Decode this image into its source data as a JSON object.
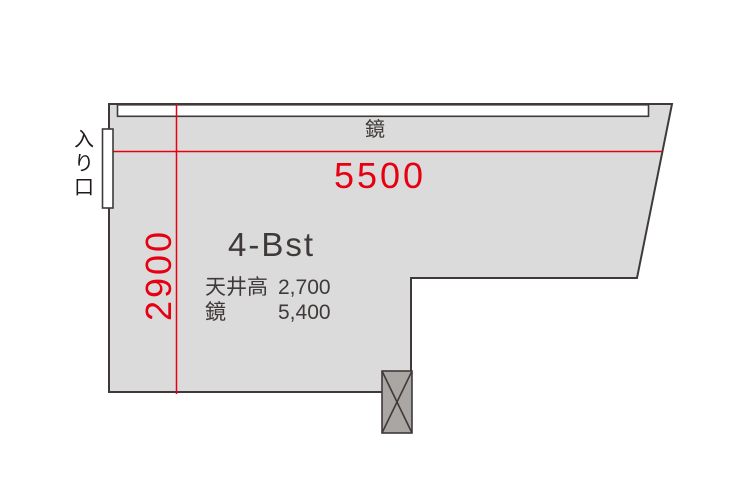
{
  "palette": {
    "room_fill": "#dbdbdb",
    "outline": "#3f3a39",
    "accent_red": "#e60012",
    "column_fill": "#a9a6a3",
    "white": "#ffffff",
    "text_dark": "#3f3a39",
    "text_black": "#1f1a18"
  },
  "floorplan": {
    "room_label": "4-Bst",
    "mirror_label": "鏡",
    "entrance_label": "入り口",
    "dimensions": {
      "width": "5500",
      "depth": "2900"
    },
    "specs": [
      {
        "label": "天井高",
        "value": "2,700"
      },
      {
        "label": "鏡",
        "value": "5,400"
      }
    ]
  }
}
